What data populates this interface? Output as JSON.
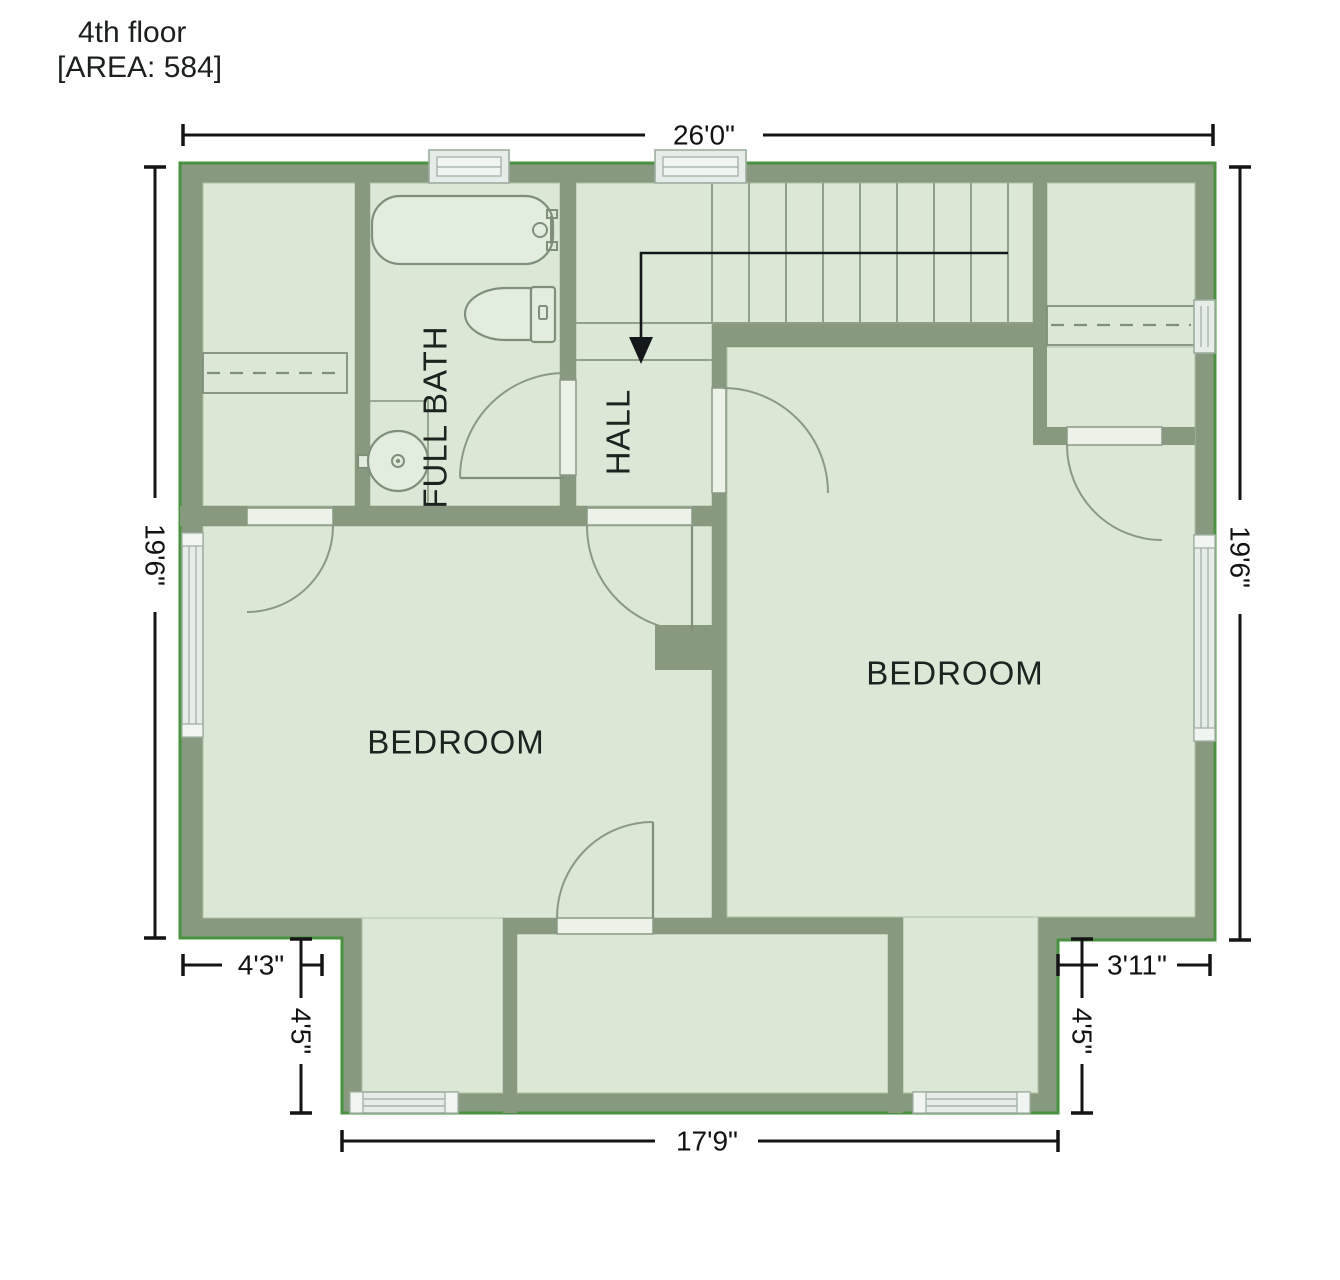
{
  "title": {
    "floor": "4th floor",
    "area": "[AREA: 584]"
  },
  "rooms": {
    "bath": "FULL BATH",
    "hall": "HALL",
    "bedroom_left": "BEDROOM",
    "bedroom_right": "BEDROOM"
  },
  "dimensions": {
    "top_width": "26'0\"",
    "left_height": "19'6\"",
    "right_height": "19'6\"",
    "bottom_width": "17'9\"",
    "bottom_left_width": "4'3\"",
    "bottom_left_depth": "4'5\"",
    "bottom_right_width": "3'11\"",
    "bottom_right_depth": "4'5\""
  },
  "colors": {
    "wall": "#87997F",
    "floor": "#DBE8D5",
    "outline_green": "#4A9140",
    "fixture_stroke": "#7E907A",
    "window_fill": "#E6EDE9",
    "dimension_line": "#141414",
    "text": "#1d2420"
  }
}
